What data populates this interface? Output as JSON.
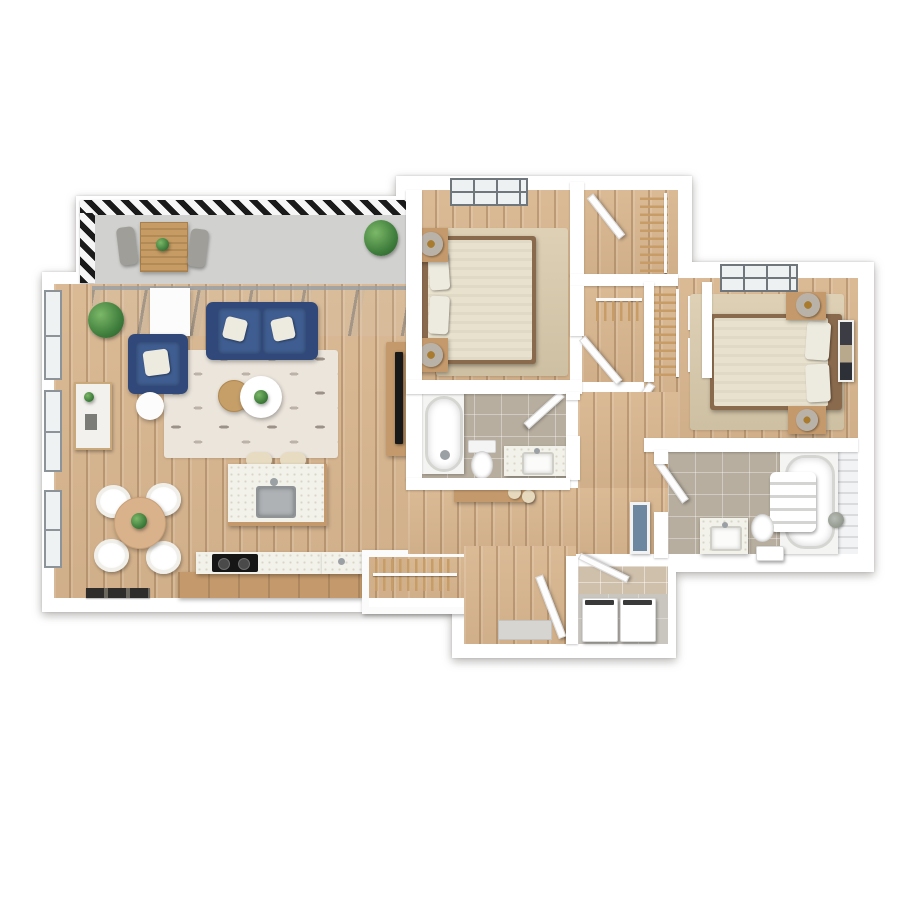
{
  "meta": {
    "type": "3d-floor-plan",
    "description": "Top-down 3D rendering of a two-bedroom, two-bathroom apartment with balcony, open living/dining/kitchen, hallway, walk-in closets, entry and laundry closet",
    "visible_text": []
  },
  "palette": {
    "background": "#ffffff",
    "wall": "#ffffff",
    "wood_floor": "#d8b68f",
    "balcony_floor": "#d1d1cf",
    "tile_floor": "#b7ae9f",
    "laundry_floor": "#c9c6bf",
    "laundry_tile_wall": "#cfc0ac",
    "awning_stripe_dark": "#1a1a1a",
    "glass_gray": "#97a0a6",
    "sofa_blue": "#3f5d90",
    "accent_wood": "#c49a6c",
    "rug_light": "#ebe5dc",
    "rug_beige": "#d9caab",
    "counter_speckle": "#f2f1ea",
    "plant_green": "#3e7d3c",
    "fixture_white": "#ffffff"
  },
  "rooms": {
    "balcony": "Balcony",
    "living_room": "Living room",
    "dining_area": "Dining area",
    "kitchen": "Kitchen",
    "bedroom_1": "Bedroom 1",
    "closet_1": "Walk-in closet",
    "hallway": "Hallway",
    "bathroom_1": "Bathroom 1",
    "bedroom_2": "Bedroom 2",
    "closet_2": "Bedroom 2 closet",
    "bathroom_2": "Bathroom 2",
    "entry": "Entry",
    "laundry": "Laundry closet"
  },
  "furniture": {
    "balcony": [
      "Striped awning edge",
      "Outdoor slat table",
      "Outdoor chair",
      "Outdoor chair",
      "Potted plant",
      "Table plant"
    ],
    "living_room": [
      "Blue sofa",
      "White throw pillows",
      "Blue armchair",
      "Patterned area rug",
      "Round wood coffee table",
      "Round white coffee table",
      "Coffee table plant",
      "White side table",
      "Round white accent table",
      "Corner potted plant",
      "Marble console table",
      "TV sideboard",
      "Television",
      "Dark doormat",
      "Coat rack with hangers",
      "Glass sliding doors"
    ],
    "dining_area": [
      "Round dining table",
      "Dining chair",
      "Dining chair",
      "Dining chair",
      "Dining chair",
      "Centerpiece plant"
    ],
    "kitchen": [
      "Kitchen island with sink",
      "Island faucet",
      "Bar stool",
      "Bar stool",
      "Base cabinets",
      "Countertop",
      "Cooktop",
      "Counter sink"
    ],
    "bedroom_1": [
      "Double bed",
      "Pillows",
      "Headboard",
      "Nightstand with lamp",
      "Nightstand with lamp",
      "Beige area rug",
      "Window",
      "Door"
    ],
    "closet_1": [
      "Hanging rod with clothes hangers",
      "Closet door"
    ],
    "hallway": [
      "Console desk",
      "Two cream poufs",
      "Wall mirror",
      "Hall closet hanging rod"
    ],
    "bathroom_1": [
      "Bathtub",
      "Toilet",
      "Vanity with sink",
      "Door"
    ],
    "bedroom_2": [
      "Double bed",
      "Pillows",
      "Headboard",
      "Nightstand with lamp",
      "Nightstand with lamp",
      "Beige area rug",
      "Window",
      "Wall art"
    ],
    "closet_2": [
      "Hanging rod with clothes hangers",
      "Shelves",
      "Closet door"
    ],
    "bathroom_2": [
      "Bathtub with tiled surround",
      "Towel shelf with folded towels",
      "Toilet",
      "Vanity with sink",
      "Small plant",
      "Storage box",
      "Door"
    ],
    "entry": [
      "Front door",
      "Entry mat"
    ],
    "laundry": [
      "Washer",
      "Dryer",
      "Tiled wall",
      "Door"
    ]
  }
}
